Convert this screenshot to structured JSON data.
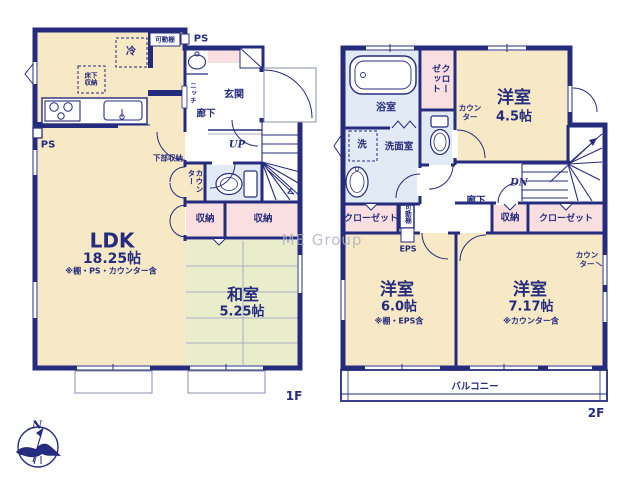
{
  "watermark": "ME Group",
  "compass": {
    "north": "N"
  },
  "palette": {
    "wall_navy": "#262c7d",
    "room_cream": "#f7e8c6",
    "tatami_green": "#e9edcb",
    "closet_pink": "#f9dfdf",
    "wet_area_blue": "#e2eaf6",
    "grid_gray": "#a9b0c6",
    "watermark_gray": "#aab0c2"
  },
  "floor1": {
    "floor_label": "1F",
    "ldk": {
      "name": "LDK",
      "size": "18.25帖",
      "note": "※棚・PS・カウンター含"
    },
    "washitsu": {
      "name": "和室",
      "size": "5.25帖"
    },
    "genkan": "玄関",
    "hall": "廊下",
    "up": "UP",
    "niche": "ニッチ",
    "movable_shelf": "可動棚",
    "ps_top": "PS",
    "ps_side": "PS",
    "fridge": "冷",
    "underfloor_storage": "床下収納",
    "lower_cabinet": "下部収納",
    "counter": "カウンター",
    "storage_a": "収納",
    "storage_b": "収納"
  },
  "floor2": {
    "floor_label": "2F",
    "bath": "浴室",
    "washroom": "洗面室",
    "laundry": "洗",
    "closet_top": "クローゼット",
    "counter_a": "カウンター",
    "room_a": {
      "name": "洋室",
      "size": "4.5帖"
    },
    "hall": "廊下",
    "dn": "DN",
    "closet_left": "クローゼット",
    "movable_shelf": "可動棚",
    "eps": "EPS",
    "storage": "収納",
    "closet_right": "クローゼット",
    "room_b": {
      "name": "洋室",
      "size": "6.0帖",
      "note": "※棚・EPS含"
    },
    "room_c": {
      "name": "洋室",
      "size": "7.17帖",
      "note": "※カウンター含"
    },
    "counter_b": "カウンター",
    "balcony": "バルコニー"
  }
}
